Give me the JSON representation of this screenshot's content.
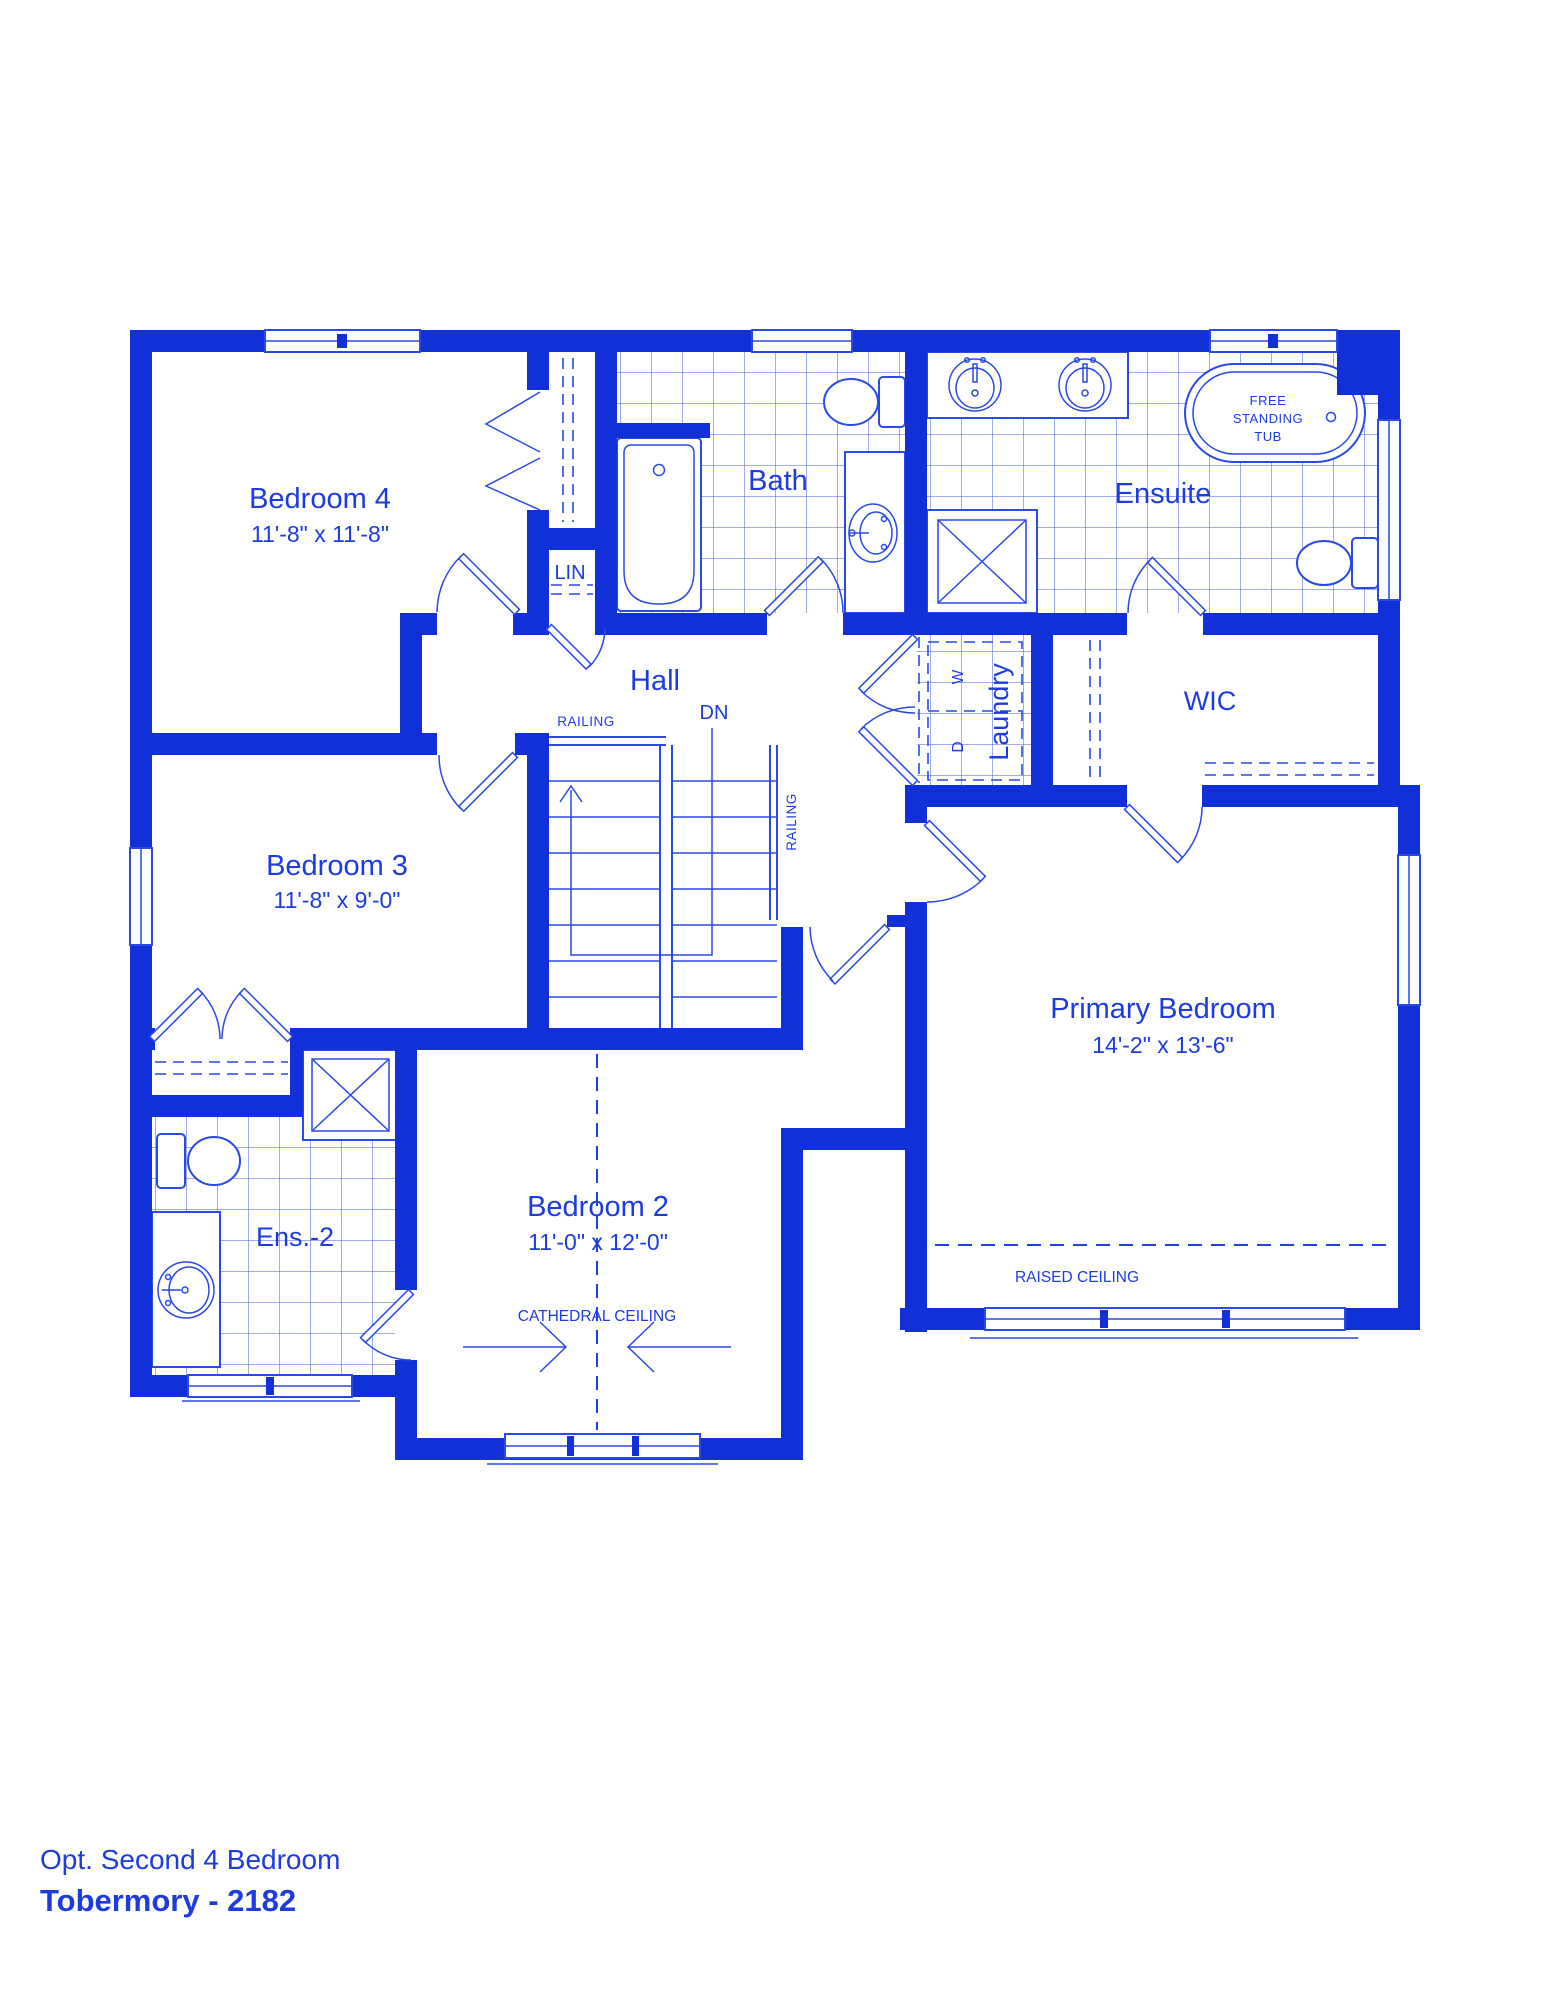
{
  "colors": {
    "wall_blue": "#1230d8",
    "line_blue": "#2a49e5",
    "text_blue": "#1e3be0",
    "tile_blue": "#4055e0",
    "background": "#ffffff"
  },
  "rooms": {
    "bedroom4": {
      "name": "Bedroom 4",
      "dims": "11'-8\" x 11'-8\""
    },
    "bath": {
      "name": "Bath"
    },
    "ensuite": {
      "name": "Ensuite"
    },
    "hall": {
      "name": "Hall"
    },
    "wic": {
      "name": "WIC"
    },
    "laundry": {
      "name": "Laundry"
    },
    "bedroom3": {
      "name": "Bedroom 3",
      "dims": "11'-8\" x 9'-0\""
    },
    "primary": {
      "name": "Primary Bedroom",
      "dims": "14'-2\" x 13'-6\""
    },
    "bedroom2": {
      "name": "Bedroom 2",
      "dims": "11'-0\" x 12'-0\""
    },
    "ens2": {
      "name": "Ens.-2"
    }
  },
  "labels": {
    "lin": "LIN",
    "dn": "DN",
    "railing_top": "RAILING",
    "railing_side": "RAILING",
    "washer": "W",
    "dryer": "D",
    "tub_line1": "FREE",
    "tub_line2": "STANDING",
    "tub_line3": "TUB",
    "cathedral": "CATHEDRAL CEILING",
    "raised": "RAISED CEILING"
  },
  "footer": {
    "subtitle": "Opt. Second 4 Bedroom",
    "title": "Tobermory - 2182"
  }
}
